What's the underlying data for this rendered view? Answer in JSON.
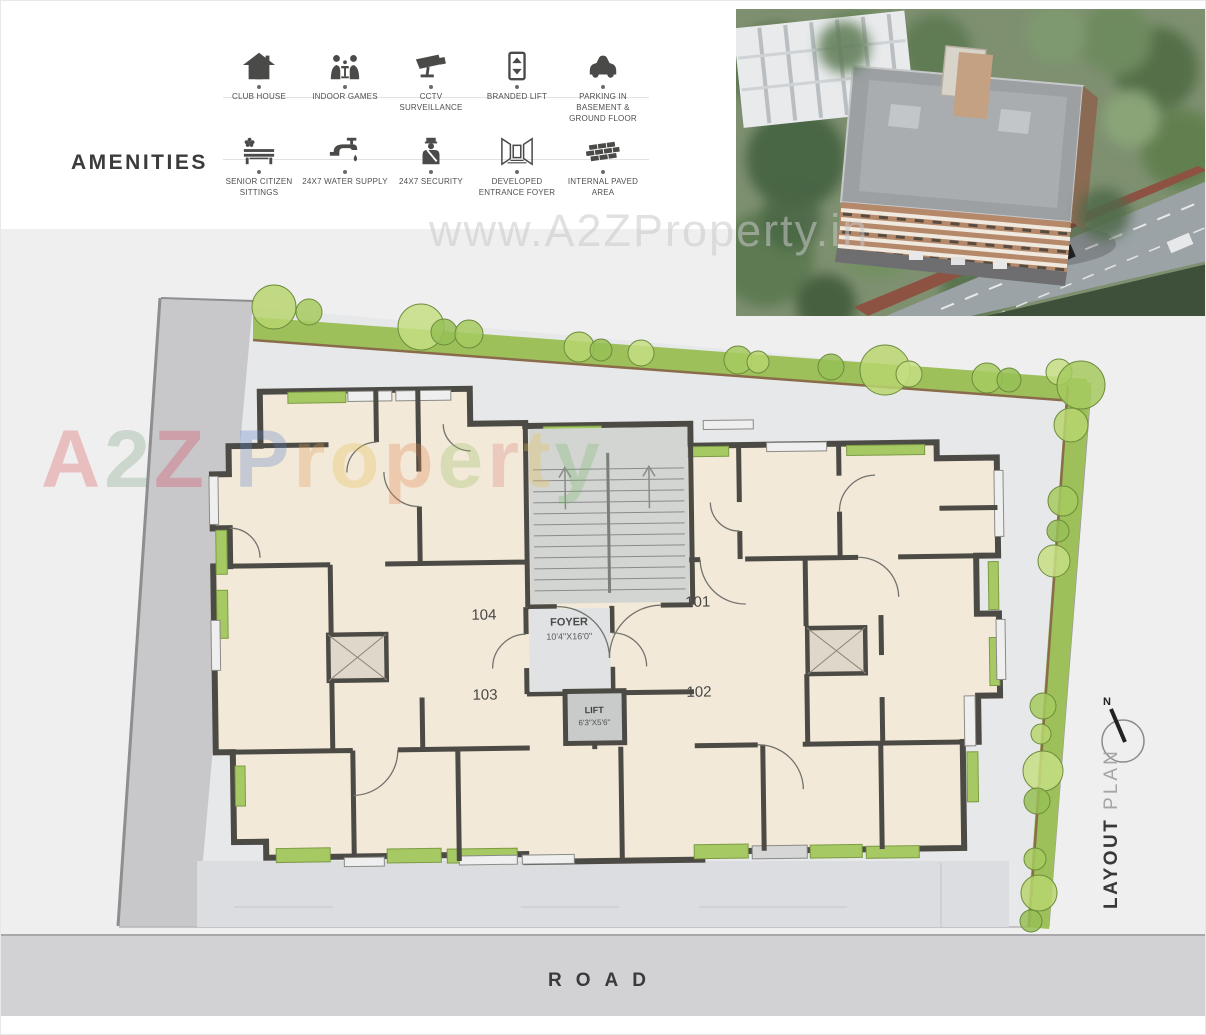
{
  "amenities": {
    "title": "AMENITIES",
    "items": [
      {
        "label": "CLUB HOUSE",
        "icon": "club-house-icon"
      },
      {
        "label": "INDOOR GAMES",
        "icon": "indoor-games-icon"
      },
      {
        "label": "CCTV SURVEILLANCE",
        "icon": "cctv-icon"
      },
      {
        "label": "BRANDED LIFT",
        "icon": "lift-icon"
      },
      {
        "label": "PARKING IN BASEMENT & GROUND FLOOR",
        "icon": "parking-icon"
      },
      {
        "label": "SENIOR CITIZEN SITTINGS",
        "icon": "bench-icon"
      },
      {
        "label": "24X7 WATER SUPPLY",
        "icon": "water-tap-icon"
      },
      {
        "label": "24X7 SECURITY",
        "icon": "security-guard-icon"
      },
      {
        "label": "DEVELOPED ENTRANCE FOYER",
        "icon": "entrance-foyer-icon"
      },
      {
        "label": "INTERNAL PAVED AREA",
        "icon": "paved-area-icon"
      }
    ]
  },
  "plan": {
    "units": [
      "104",
      "101",
      "103",
      "102"
    ],
    "foyer": {
      "label": "FOYER",
      "dims": "10'4\"X16'0\""
    },
    "lift": {
      "label": "LIFT",
      "dims": "6'3\"X5'6\""
    },
    "north_label": "N",
    "layout_word": "LAYOUT",
    "plan_word": "PLAN",
    "road_label": "ROAD"
  },
  "watermarks": {
    "url": "www.A2ZProperty.in",
    "brand": "A2Z Property",
    "brand_letters": [
      "A",
      "2",
      "Z",
      " ",
      "P",
      "r",
      "o",
      "p",
      "e",
      "r",
      "t",
      "y"
    ]
  },
  "colors": {
    "wall": "#4c4a45",
    "room": "#f3e9d8",
    "balcony_green": "#a6c964",
    "hedge_green": "#9dc05a",
    "road_band": "#d2d2d4"
  }
}
